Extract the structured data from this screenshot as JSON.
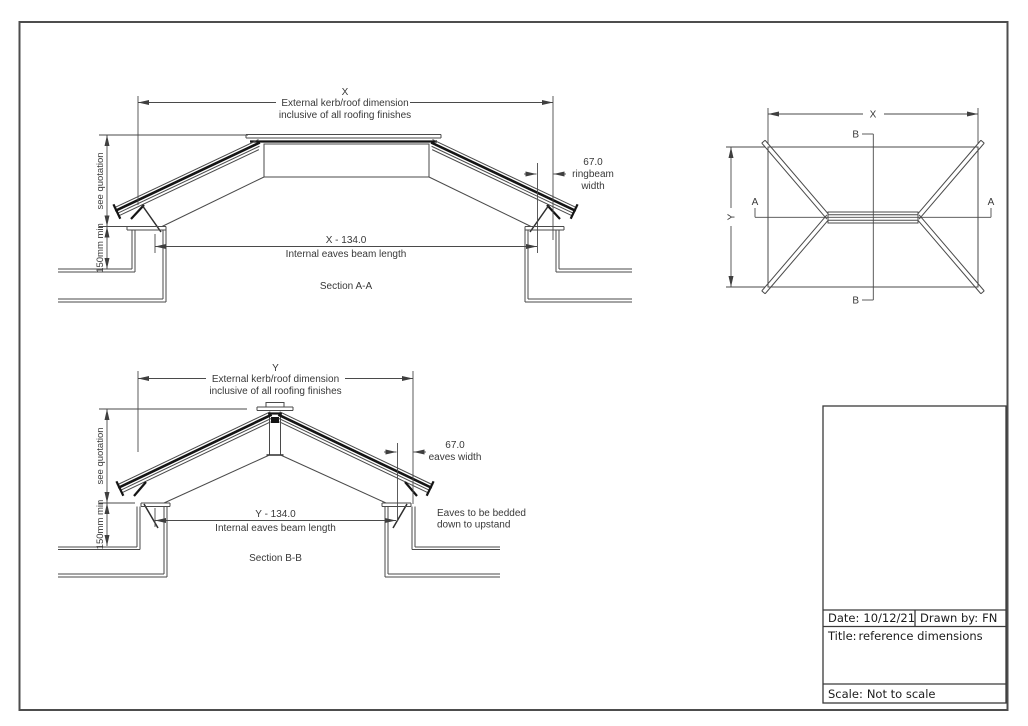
{
  "drawing": {
    "line_color": "#4a4a4a",
    "dark_color": "#141414",
    "text_color": "#383838",
    "border_color": "#4d4d4d"
  },
  "section_aa": {
    "dim_letter": "X",
    "external_dim_line1": "External kerb/roof dimension",
    "external_dim_line2": "inclusive of all roofing finishes",
    "see_quotation": "see quotation",
    "upstand_min": "150mm min",
    "ringbeam_value": "67.0",
    "ringbeam_label_line1": "ringbeam",
    "ringbeam_label_line2": "width",
    "internal_dim": "X - 134.0",
    "internal_label": "Internal eaves beam length",
    "caption": "Section A-A"
  },
  "section_bb": {
    "dim_letter": "Y",
    "external_dim_line1": "External kerb/roof dimension",
    "external_dim_line2": "inclusive of all roofing finishes",
    "see_quotation": "see quotation",
    "upstand_min": "150mm min",
    "eaves_value": "67.0",
    "eaves_label": "eaves width",
    "internal_dim": "Y - 134.0",
    "internal_label": "Internal eaves beam length",
    "caption": "Section B-B",
    "note_line1": "Eaves to be bedded",
    "note_line2": "down to upstand"
  },
  "plan": {
    "dim_x": "X",
    "dim_y": "Y",
    "section_a": "A",
    "section_b": "B"
  },
  "title_block": {
    "date_label": "Date:",
    "date_value": "10/12/21",
    "drawn_label": "Drawn by:",
    "drawn_value": "FN",
    "title_label": "Title:",
    "title_value": "reference dimensions",
    "scale_label": "Scale:",
    "scale_value": "Not to scale"
  }
}
